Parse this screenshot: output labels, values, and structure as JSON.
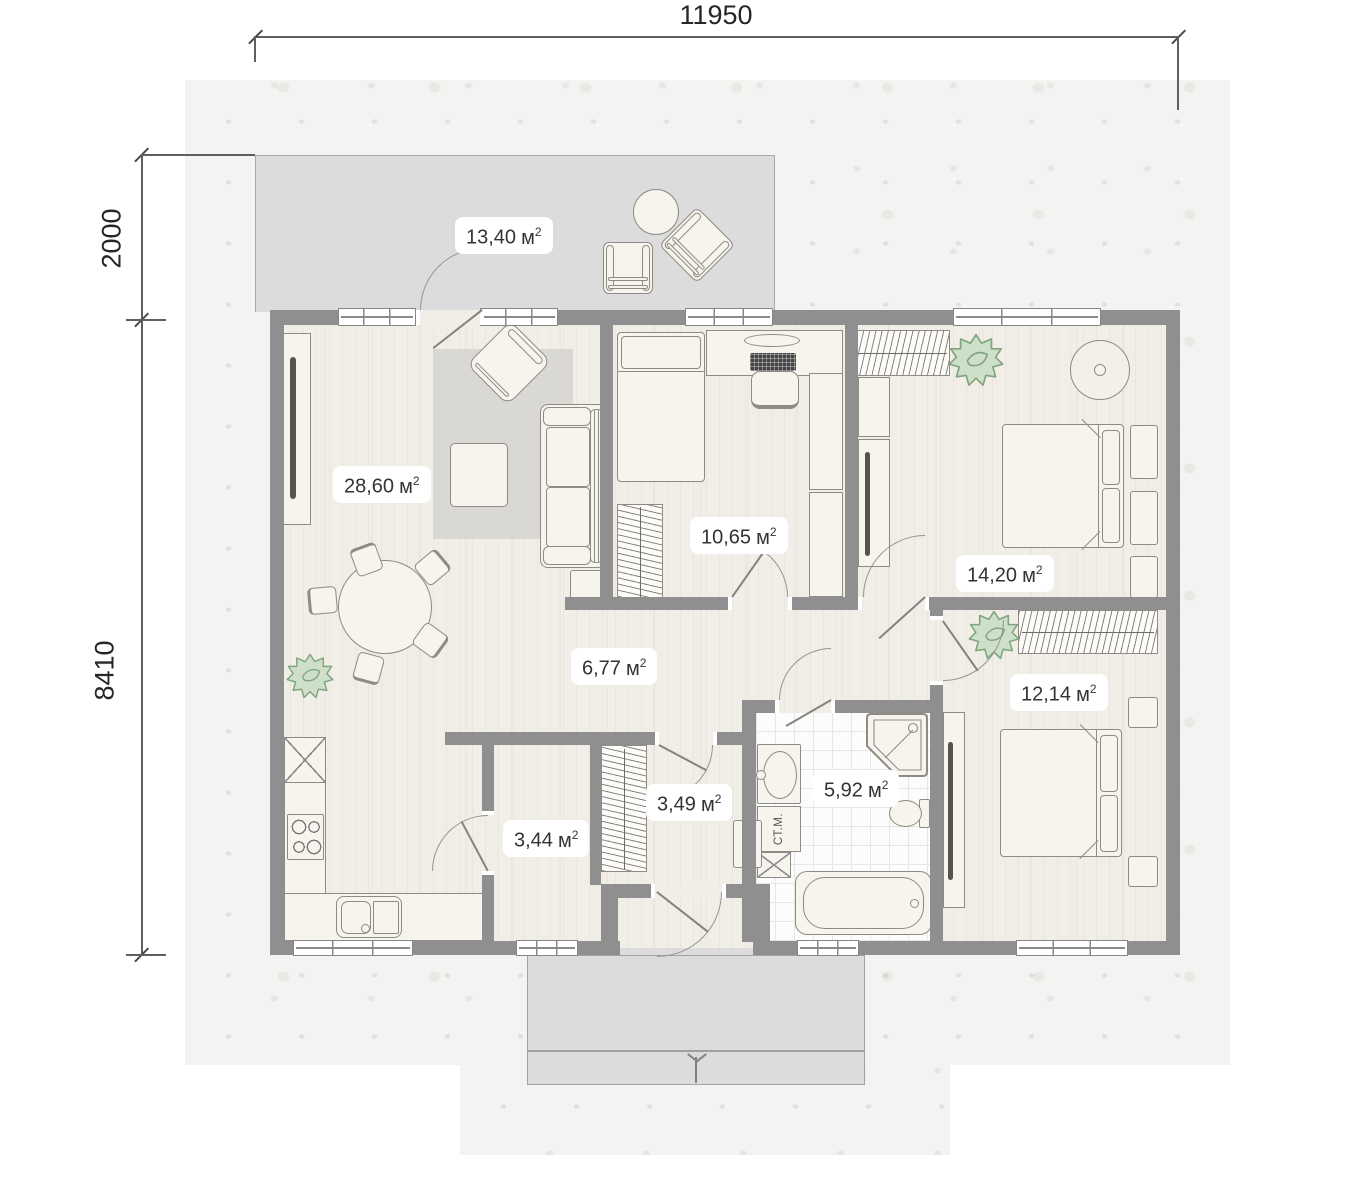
{
  "dimensions": {
    "top": "11950",
    "left_upper": "2000",
    "left_lower": "8410"
  },
  "unit": {
    "base": "м",
    "sup": "2"
  },
  "rooms": {
    "terrace": {
      "area": "13,40"
    },
    "living_room": {
      "area": "28,60"
    },
    "kids_room": {
      "area": "10,65"
    },
    "bedroom_1": {
      "area": "14,20"
    },
    "hallway": {
      "area": "6,77"
    },
    "bedroom_2": {
      "area": "12,14"
    },
    "bathroom": {
      "area": "5,92"
    },
    "entry": {
      "area": "3,49"
    },
    "storage": {
      "area": "3,44"
    }
  },
  "appliances": {
    "washing_machine_label": "СТ.М."
  },
  "colors": {
    "wall": "#8f8f8f",
    "room_floor": "#f1ede7",
    "outdoor_floor": "#dcdcdc",
    "bathroom_tile": "#fcfcfc",
    "furniture_fill": "#f7f4ee",
    "furniture_outline": "#8e8b84",
    "plant_green": "#cfe0ca",
    "label_text": "#333333",
    "dimension_text": "#262626"
  }
}
